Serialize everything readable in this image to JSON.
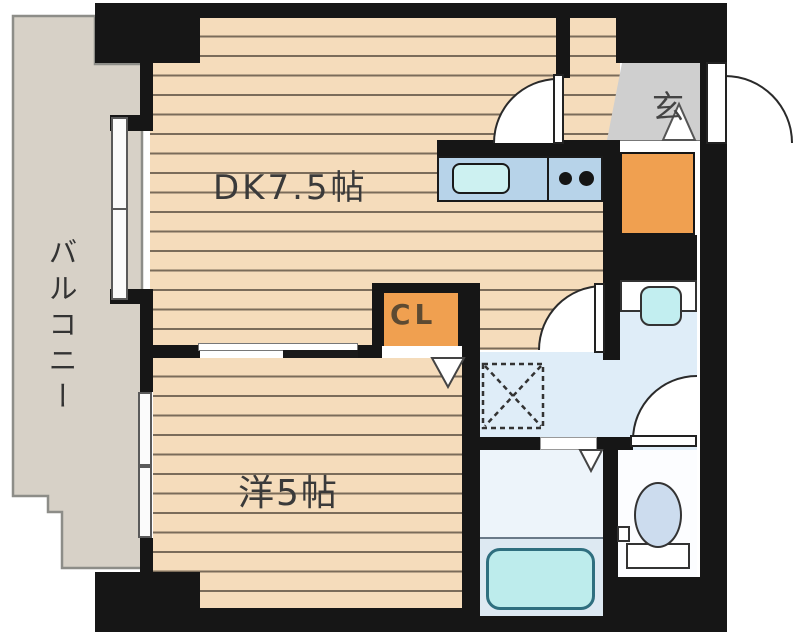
{
  "plan_title": "1DK apartment floor plan",
  "rooms": {
    "balcony": {
      "label": "バルコニー"
    },
    "dining_kitchen": {
      "label": "DK7.5帖"
    },
    "western_room": {
      "label": "洋5帖"
    },
    "closet": {
      "label": "CL"
    },
    "entrance": {
      "label": "玄"
    }
  },
  "fixtures": [
    "kitchen-counter",
    "kitchen-sink",
    "stove-burners",
    "shoe-cabinet",
    "washbasin",
    "washing-machine-space",
    "toilet",
    "bathtub"
  ],
  "colors": {
    "wall": "#161616",
    "wood_floor": "#f5dcbb",
    "plank_line": "#5c5042",
    "balcony_gray": "#d7d1c7",
    "entrance_gray": "#cfcfcf",
    "accent_orange": "#f0a050",
    "counter_blue": "#b7d3e9",
    "sink_cyan": "#cdf1f1",
    "washroom_blue": "#dfedf8",
    "bathroom_blue": "#edf4fa",
    "bathtub_cyan": "#bdecec",
    "toilet_blue": "#ccdcee"
  }
}
